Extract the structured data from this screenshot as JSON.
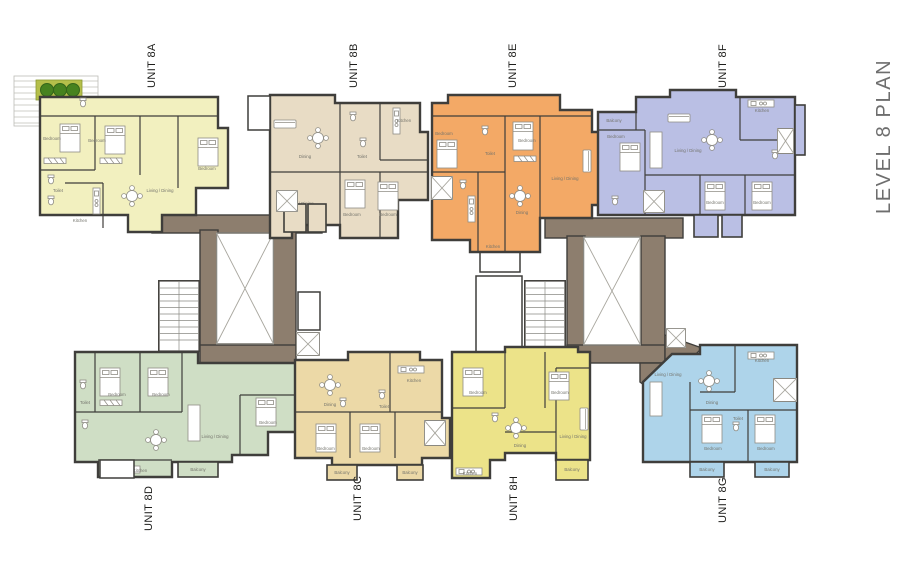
{
  "title": {
    "text": "LEVEL 8 PLAN"
  },
  "colors": {
    "wall": "#3f3e3b",
    "core": "#8d7e6e",
    "title_text": "#6e6e6e",
    "unit_label_text": "#1d1d1b",
    "room_label_text": "#73736b",
    "planter": "#b5bf4a",
    "tree": "#47821f"
  },
  "units": [
    {
      "id": "8A",
      "label": "UNIT 8A",
      "color": "#f2f0bf"
    },
    {
      "id": "8B",
      "label": "UNIT 8B",
      "color": "#e8dcc5"
    },
    {
      "id": "8E",
      "label": "UNIT 8E",
      "color": "#f3a966"
    },
    {
      "id": "8F",
      "label": "UNIT 8F",
      "color": "#babfe4"
    },
    {
      "id": "8D",
      "label": "UNIT 8D",
      "color": "#cfdec5"
    },
    {
      "id": "8C",
      "label": "UNIT 8C",
      "color": "#ecd9a7"
    },
    {
      "id": "8H",
      "label": "UNIT 8H",
      "color": "#ece389"
    },
    {
      "id": "8G",
      "label": "UNIT 8G",
      "color": "#aed4ea"
    }
  ],
  "rooms": {
    "bedroom": "Bedroom",
    "living": "Living / Dining",
    "dining": "Dining",
    "kitchen": "Kitchen",
    "toilet": "Toilet",
    "balcony": "Balcony"
  }
}
